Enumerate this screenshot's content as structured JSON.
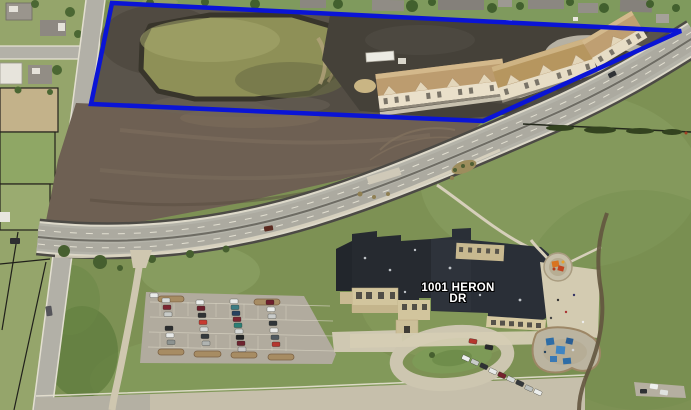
{
  "scene": {
    "type": "aerial-imagery",
    "address_label": {
      "line1": "1001 HERON",
      "line2": "DR"
    }
  },
  "annotation": {
    "name": "highlighted-parcel-outline",
    "shape": "quadrilateral",
    "color": "#0A14D6",
    "points": "112,3 681,31 483,121 91,104"
  },
  "palette": {
    "annotation_blue": "#0A14D6",
    "field_green": "#7d9154",
    "lawn_green": "#8ea267",
    "plowed_dirt_brown": "#6e6053",
    "excavation_dark": "#5a544b",
    "pond_water_olive": "#8e9057",
    "road_asphalt_gray": "#b4b3a9",
    "concrete_walk_tan": "#d5cdb4",
    "parking_lot_gray": "#b1ab9e",
    "school_roof_charcoal": "#262a30",
    "school_wall_tan": "#d2c59d",
    "apartment_roof_tan": "#bc9c6f",
    "apartment_wall_cream": "#eae0ca",
    "playground_blue": "#3f85c2",
    "playground_orange": "#d9731f",
    "parcel_line_black": "#20201b",
    "label_text_white": "#ffffff"
  }
}
